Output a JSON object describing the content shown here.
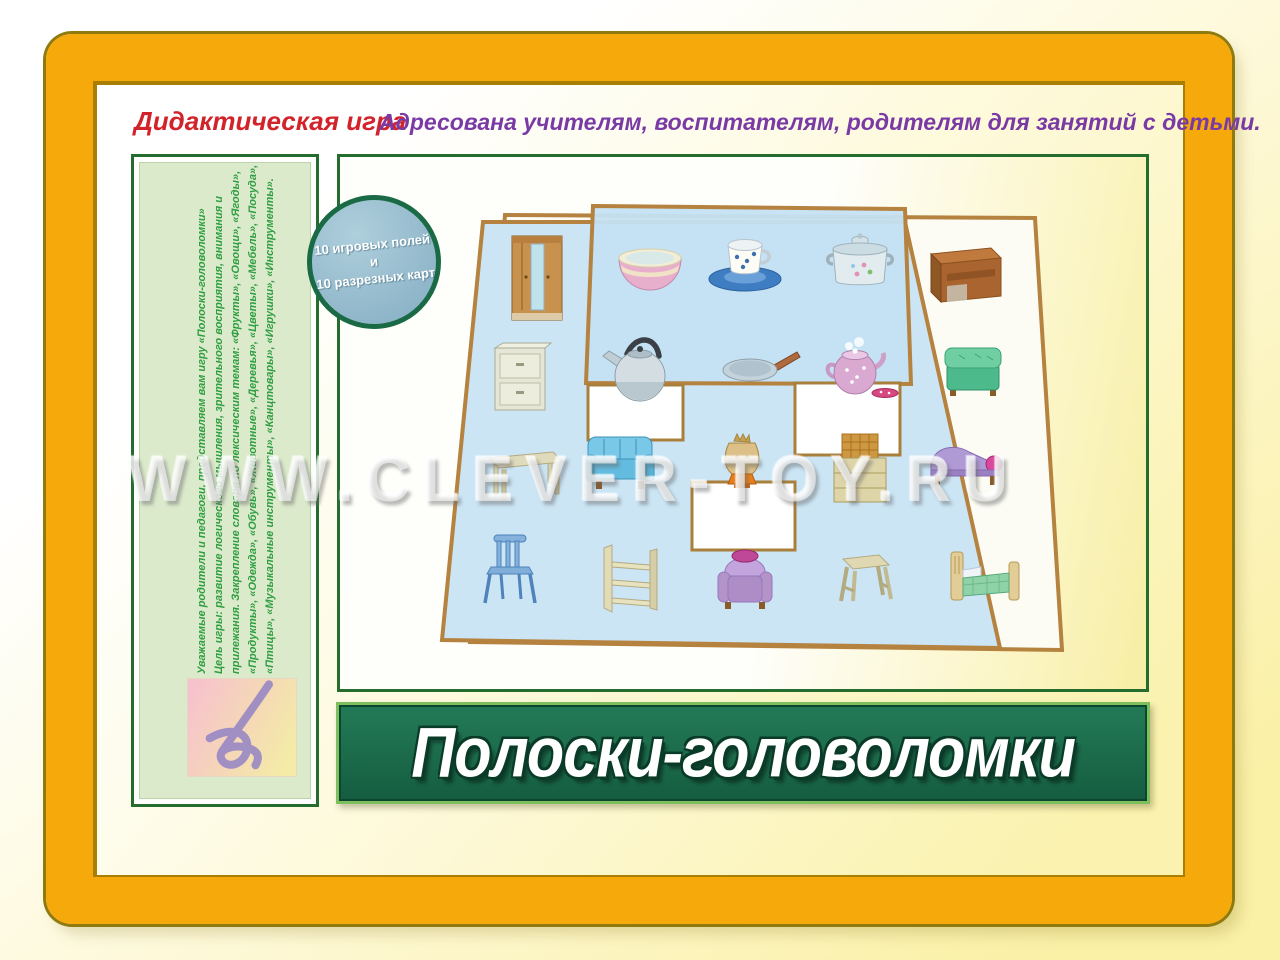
{
  "header": {
    "label": "Дидактическая игра",
    "audience": "Адресована учителям, воспитателям, родителям для занятий с детьми."
  },
  "badge": {
    "line1": "10 игровых полей и",
    "line2": "10 разрезных карт"
  },
  "sidebar": {
    "lines": [
      "Уважаемые родители и педагоги, представляем вам игру «Полоски-головоломки»",
      "Цель игры: развитие логического мышления, зрительного восприятия, внимания и",
      "прилежания. Закрепление словаря по лексическим темам: «Фрукты», «Овощи», «Ягоды»,",
      "«Продукты», «Одежда», «Обувь», «Животные», «Деревья», «Цветы», «Мебель», «Посуда»,",
      "«Птицы», «Музыкальные инструменты», «Канцтовары», «Игрушки», «Инструменты»."
    ],
    "logo": "publisher-script-letter-mark"
  },
  "banner": {
    "title": "Полоски-головоломки"
  },
  "watermark": "WWW.CLEVER-TOY.RU",
  "board": {
    "fields": [
      "blank-field",
      "furniture-field",
      "dishes-overlay-field"
    ],
    "cutout_windows": 3,
    "furniture_items": [
      "wardrobe",
      "desk",
      "nightstand",
      "ottoman",
      "table",
      "sofa",
      "samovar",
      "wicker-chest",
      "chaise-longue",
      "chair",
      "shelf-unit",
      "armchair",
      "stool",
      "bed"
    ],
    "dishes_items": [
      "bowl",
      "cup-and-saucer",
      "pot",
      "kettle",
      "frying-pan",
      "teapot"
    ]
  },
  "colors": {
    "frame_gold": "#F6A90B",
    "frame_outline": "#8F7A10",
    "panel_border_green": "#256D2F",
    "sidebar_bg": "#DCEACC",
    "sidebar_text_green": "#2F9E41",
    "banner_green": "#1D6F4E",
    "board_blue": "#CBE5F5",
    "board_border_tan": "#B5823F",
    "badge_blue": "#96BCCE",
    "badge_ring_green": "#1A6B45",
    "header_red": "#D2232B",
    "header_purple": "#7A3AA6"
  }
}
